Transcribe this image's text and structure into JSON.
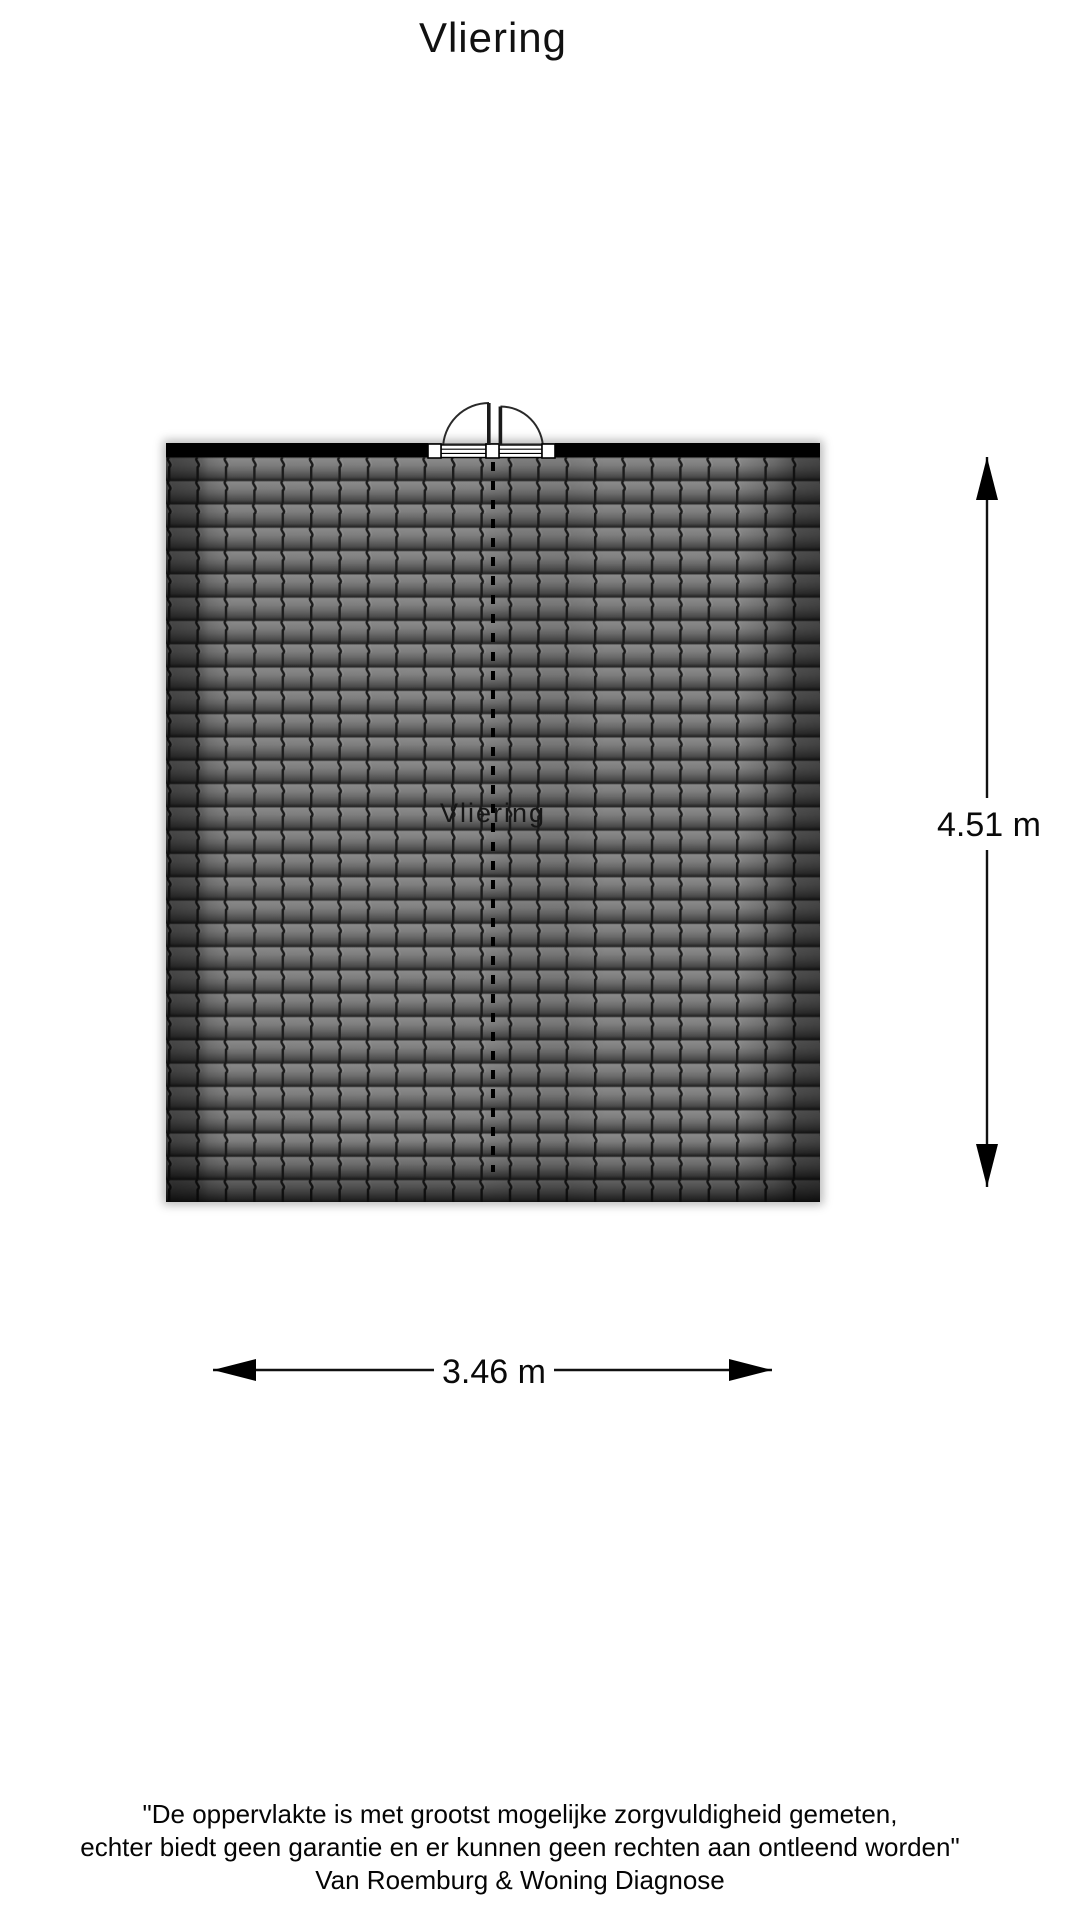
{
  "title": "Vliering",
  "plan": {
    "room_label": "Vliering",
    "colors": {
      "wall": "#000000",
      "tile_base": "#787878",
      "tile_highlight": "#8e8e8e",
      "tile_shadow": "#4e4e4e",
      "tile_line": "#1c1c1c",
      "dashed_line": "#000000"
    }
  },
  "dimensions": {
    "height_label": "4.51 m",
    "width_label": "3.46 m"
  },
  "footer": {
    "line1": "\"De oppervlakte is met grootst mogelijke zorgvuldigheid gemeten,",
    "line2": "echter biedt geen garantie en er kunnen geen rechten aan ontleend worden\"",
    "line3": "Van Roemburg & Woning Diagnose"
  }
}
